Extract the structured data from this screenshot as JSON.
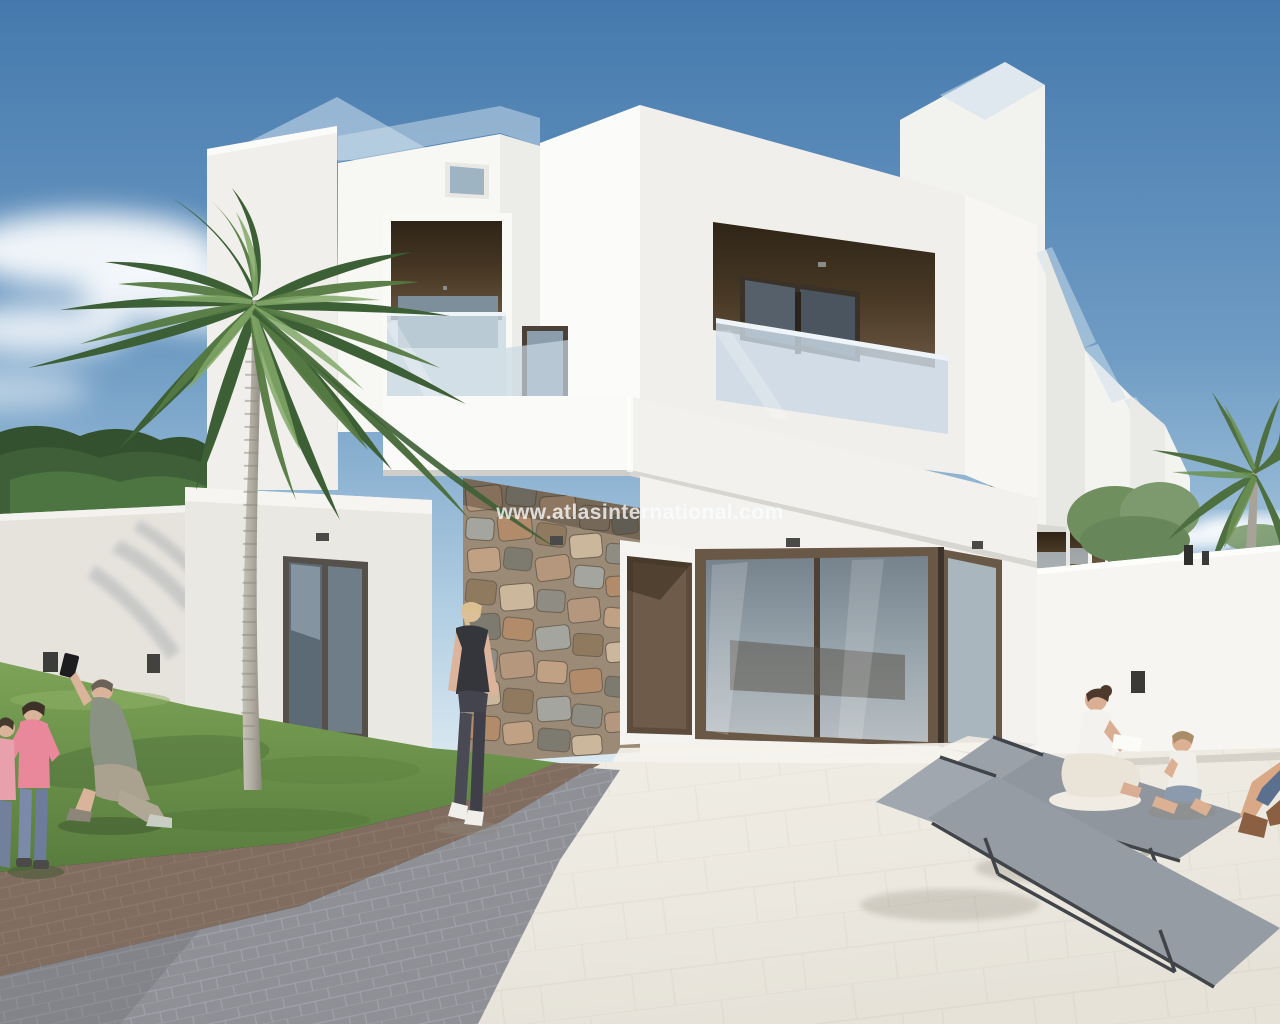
{
  "page": {
    "title": "New-build modern villa — exterior 3D render"
  },
  "watermark": {
    "text": "www.atlasinternational.com",
    "color": "#ffffff",
    "opacity": 0.78
  },
  "scene": {
    "type": "architectural-render",
    "description": "Two-storey white cubist villa with glass-balustraded roof terraces and balconies, dark brown recessed openings, natural stone feature wall at the entrance, lawn with palm tree, paved patio with sun loungers, perimeter walls, row of identical townhouses receding to the right.",
    "palette": {
      "sky_top": "#4579ad",
      "sky_horizon": "#e2edf4",
      "wall_white_lit": "#fbfbf9",
      "wall_white": "#f4f4f1",
      "wall_white_shade": "#e9e8e3",
      "balcony_recess_brown": "#4a3a26",
      "joinery_brown": "#6a5847",
      "window_glass": "#8c9dab",
      "balustrade_glass": "#c9d8e4",
      "stone_tan": "#b3977c",
      "stone_gray": "#8f8c83",
      "grass": "#719750",
      "hedge": "#3f5f38",
      "palm_green": "#5d8049",
      "trunk": "#b5b0a6",
      "paver_gray": "#8e9095",
      "paver_brown": "#9a8172",
      "patio": "#ece9e1",
      "lounger_mesh": "#969da4",
      "lounger_frame": "#41454a",
      "table_concrete": "#e3e0d9"
    },
    "objects": [
      {
        "id": "main-villa",
        "desc": "white villa with two brown recessed balconies, roof glass balustrades, stone-clad entry column, brown front door and corner glass sliding doors"
      },
      {
        "id": "townhouse-row",
        "desc": "identical white townhouses stepping back to the right"
      },
      {
        "id": "palm-tree-main",
        "desc": "tall palm on the lawn in front of the villa"
      },
      {
        "id": "palm-tree-right",
        "desc": "palm behind right perimeter wall"
      },
      {
        "id": "perimeter-walls",
        "desc": "white boundary walls left and right"
      },
      {
        "id": "sun-loungers",
        "desc": "two grey mesh sun loungers with round concrete side table"
      }
    ],
    "people": [
      {
        "id": "man-kneeling-photographer",
        "desc": "man kneeling on lawn taking a photo with raised phone"
      },
      {
        "id": "child-pink-1",
        "desc": "child in pink top and jeans standing on lawn"
      },
      {
        "id": "child-pink-2",
        "desc": "smaller child in pink at the far left edge"
      },
      {
        "id": "woman-walking",
        "desc": "blonde woman in dark sportswear walking toward the entrance"
      },
      {
        "id": "woman-reading",
        "desc": "woman seated cross-legged on a lounger reading a book"
      },
      {
        "id": "child-sitting",
        "desc": "child sitting on the patio facing her"
      },
      {
        "id": "person-edge",
        "desc": "partially cropped seated person at the right edge"
      }
    ]
  }
}
